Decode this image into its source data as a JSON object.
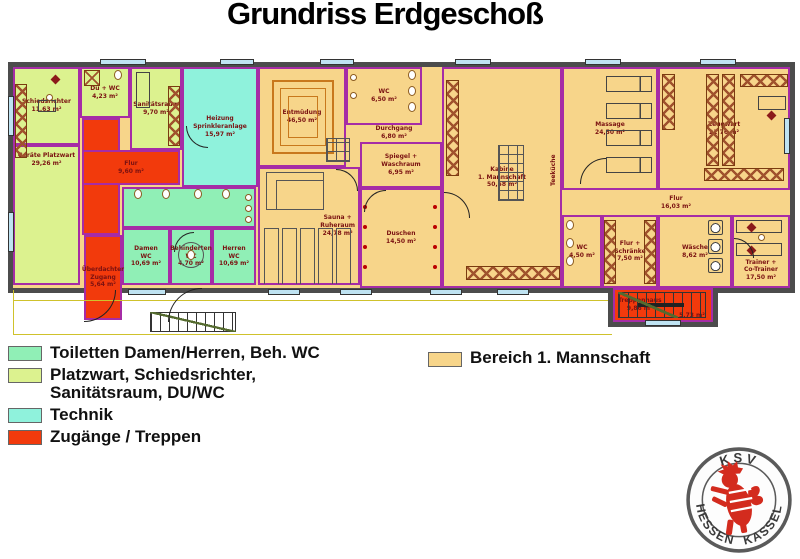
{
  "title": "Grundriss Erdgeschoß",
  "colors": {
    "team": "#F7D58A",
    "toilets": "#90EFB6",
    "platzwart": "#DCF28F",
    "technik": "#8FF2DC",
    "access": "#F23A0C",
    "wall": "#4C4C4C",
    "room_border": "#A62CA6",
    "label": "#7A1111",
    "window": "#BFE3F2"
  },
  "plan": {
    "rooms": [
      {
        "id": "schiedsrichter",
        "label": "Schiedsrichter\n11,63 m²",
        "fill": "platzwart",
        "x": 13,
        "y": 67,
        "w": 67,
        "h": 78
      },
      {
        "id": "du-wc",
        "label": "Du + WC\n4,23 m²",
        "fill": "platzwart",
        "x": 80,
        "y": 67,
        "w": 50,
        "h": 51
      },
      {
        "id": "sanitaetsraum",
        "label": "Sanitätsraum\n9,70 m²",
        "fill": "platzwart",
        "x": 130,
        "y": 67,
        "w": 52,
        "h": 83
      },
      {
        "id": "heizung",
        "label": "Heizung\nSprinkleranlage\n15,97 m²",
        "fill": "technik",
        "x": 182,
        "y": 67,
        "w": 76,
        "h": 120
      },
      {
        "id": "geraete-platzwart",
        "label": "Geräte Platzwart\n29,26 m²",
        "fill": "platzwart",
        "x": 13,
        "y": 145,
        "w": 67,
        "h": 140,
        "cls": "label-top"
      },
      {
        "id": "wc-vorraum",
        "label": "",
        "fill": "toilets",
        "x": 122,
        "y": 187,
        "w": 134,
        "h": 41
      },
      {
        "id": "damen-wc",
        "label": "Damen\nWC\n10,69 m²",
        "fill": "toilets",
        "x": 122,
        "y": 228,
        "w": 48,
        "h": 57
      },
      {
        "id": "behinderten-wc",
        "label": "Behinderten\nWC\n4,70 m²",
        "fill": "toilets",
        "x": 170,
        "y": 228,
        "w": 42,
        "h": 57
      },
      {
        "id": "herren-wc",
        "label": "Herren\nWC\n10,69 m²",
        "fill": "toilets",
        "x": 212,
        "y": 228,
        "w": 44,
        "h": 57
      },
      {
        "id": "entmuedung",
        "label": "Entmüdung\n46,50 m²",
        "fill": "team",
        "x": 258,
        "y": 67,
        "w": 88,
        "h": 100
      },
      {
        "id": "sauna-ruheraum",
        "label": "Sauna +\nRuheraum\n24,78 m²",
        "fill": "team",
        "x": 258,
        "y": 167,
        "w": 102,
        "h": 118,
        "cls": "label-right"
      },
      {
        "id": "wc-mitte",
        "label": "WC\n6,50 m²",
        "fill": "team",
        "x": 346,
        "y": 67,
        "w": 76,
        "h": 58
      },
      {
        "id": "durchgang",
        "label": "Durchgang\n6,80 m²",
        "fill": "team",
        "x": 346,
        "y": 124,
        "w": 96,
        "h": 18,
        "cls": "open"
      },
      {
        "id": "spiegel-waschraum",
        "label": "Spiegel +\nWaschraum\n6,95 m²",
        "fill": "team",
        "x": 360,
        "y": 142,
        "w": 82,
        "h": 46
      },
      {
        "id": "duschen",
        "label": "Duschen\n14,50 m²",
        "fill": "team",
        "x": 360,
        "y": 188,
        "w": 82,
        "h": 100
      },
      {
        "id": "kabine",
        "label": "Kabine\n1. Mannschaft\n50,58 m²",
        "fill": "team",
        "x": 442,
        "y": 67,
        "w": 120,
        "h": 221
      },
      {
        "id": "teekueche",
        "label": "Teeküche",
        "fill": "team",
        "x": 548,
        "y": 138,
        "w": 12,
        "h": 64,
        "cls": "open vertical"
      },
      {
        "id": "massage",
        "label": "Massage\n24,50 m²",
        "fill": "team",
        "x": 562,
        "y": 67,
        "w": 96,
        "h": 123
      },
      {
        "id": "zeugwart",
        "label": "Zeugwart\n21,76 m²",
        "fill": "team",
        "x": 658,
        "y": 67,
        "w": 132,
        "h": 123
      },
      {
        "id": "flur-ost",
        "label": "Flur\n16,03 m²",
        "fill": "team",
        "x": 562,
        "y": 190,
        "w": 228,
        "h": 25,
        "cls": "open"
      },
      {
        "id": "wc-klein",
        "label": "WC\n4,50 m²",
        "fill": "team",
        "x": 562,
        "y": 215,
        "w": 40,
        "h": 73
      },
      {
        "id": "flur-schraenke",
        "label": "Flur +\nSchränke\n7,50 m²",
        "fill": "team",
        "x": 602,
        "y": 215,
        "w": 56,
        "h": 73
      },
      {
        "id": "waesche",
        "label": "Wäsche\n8,62 m²",
        "fill": "team",
        "x": 658,
        "y": 215,
        "w": 74,
        "h": 73
      },
      {
        "id": "trainer",
        "label": "Trainer +\nCo-Trainer\n17,50 m²",
        "fill": "team",
        "x": 732,
        "y": 215,
        "w": 58,
        "h": 73,
        "cls": "label-bottom"
      },
      {
        "id": "flur-west-arm",
        "label": "",
        "fill": "access",
        "x": 82,
        "y": 118,
        "w": 38,
        "h": 117
      },
      {
        "id": "flur-west",
        "label": "Flur\n9,60 m²",
        "fill": "access",
        "x": 82,
        "y": 150,
        "w": 98,
        "h": 35
      },
      {
        "id": "ueberdachter-zugang",
        "label": "Überdachter\nZugang\n5,64 m²",
        "fill": "access",
        "x": 84,
        "y": 235,
        "w": 38,
        "h": 85
      },
      {
        "id": "treppenhaus",
        "label": "Treppenhaus\n9,86 m²",
        "fill": "access",
        "x": 613,
        "y": 288,
        "w": 100,
        "h": 34,
        "cls": "label-left"
      },
      {
        "id": "treppenhaus-flaeche",
        "label": "5,73 m²",
        "fill": "",
        "x": 674,
        "y": 310,
        "w": 36,
        "h": 11,
        "cls": "open"
      }
    ]
  },
  "legend": {
    "items": [
      {
        "label": "Toiletten Damen/Herren, Beh. WC",
        "color_key": "toilets"
      },
      {
        "label": "Platzwart, Schiedsrichter,\nSanitätsraum, DU/WC",
        "color_key": "platzwart"
      },
      {
        "label": "Technik",
        "color_key": "technik"
      },
      {
        "label": "Zugänge / Treppen",
        "color_key": "access"
      }
    ],
    "team_item": {
      "label": "Bereich 1. Mannschaft",
      "color_key": "team"
    }
  },
  "logo": {
    "top": "KSV",
    "bottom_left": "HESSEN",
    "bottom_right": "KASSEL"
  }
}
